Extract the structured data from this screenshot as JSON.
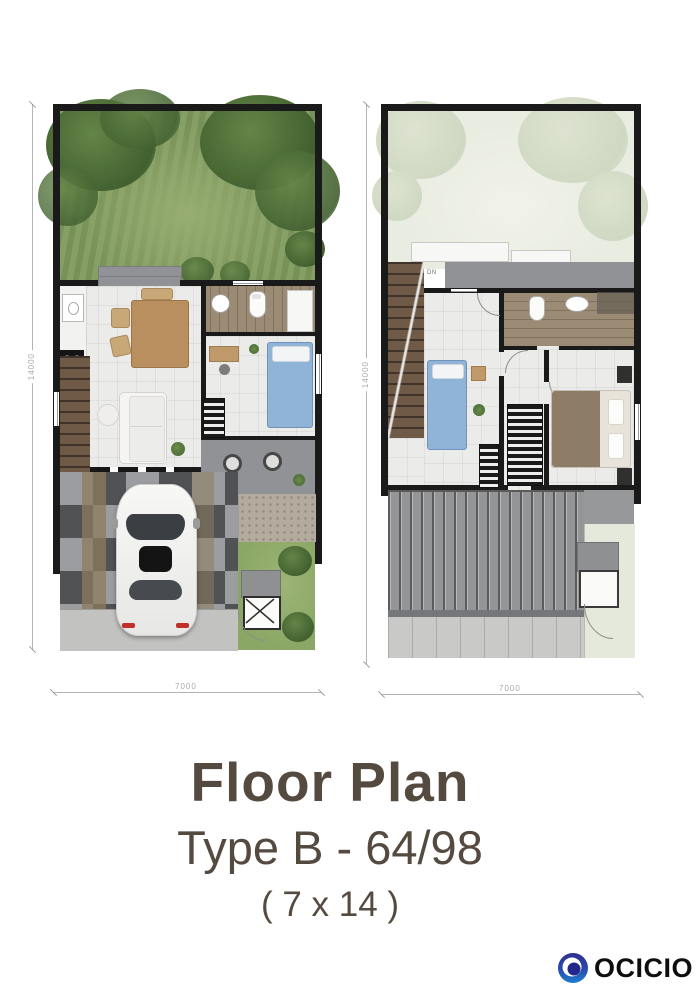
{
  "title": {
    "heading": "Floor Plan",
    "subheading": "Type B - 64/98",
    "size_note": "( 7 x 14 )"
  },
  "dimensions": {
    "first_floor_width": "7000",
    "first_floor_depth": "14000",
    "second_floor_width": "7000",
    "second_floor_depth": "14000"
  },
  "labels": {
    "stairs_down": "DN"
  },
  "logo": {
    "text": "OCICIO",
    "icon": "concentric-circle-mark",
    "color_dark_blue": "#2e2f8f",
    "color_light_blue": "#1d7fd0",
    "color_text": "#0e0e0e"
  },
  "colors": {
    "title_text": "#554a3f",
    "wall": "#1a1a1a",
    "garden_green": "#7f9a5d",
    "roof_gray": "#98999b",
    "bed_blue": "#8fb4d8"
  }
}
